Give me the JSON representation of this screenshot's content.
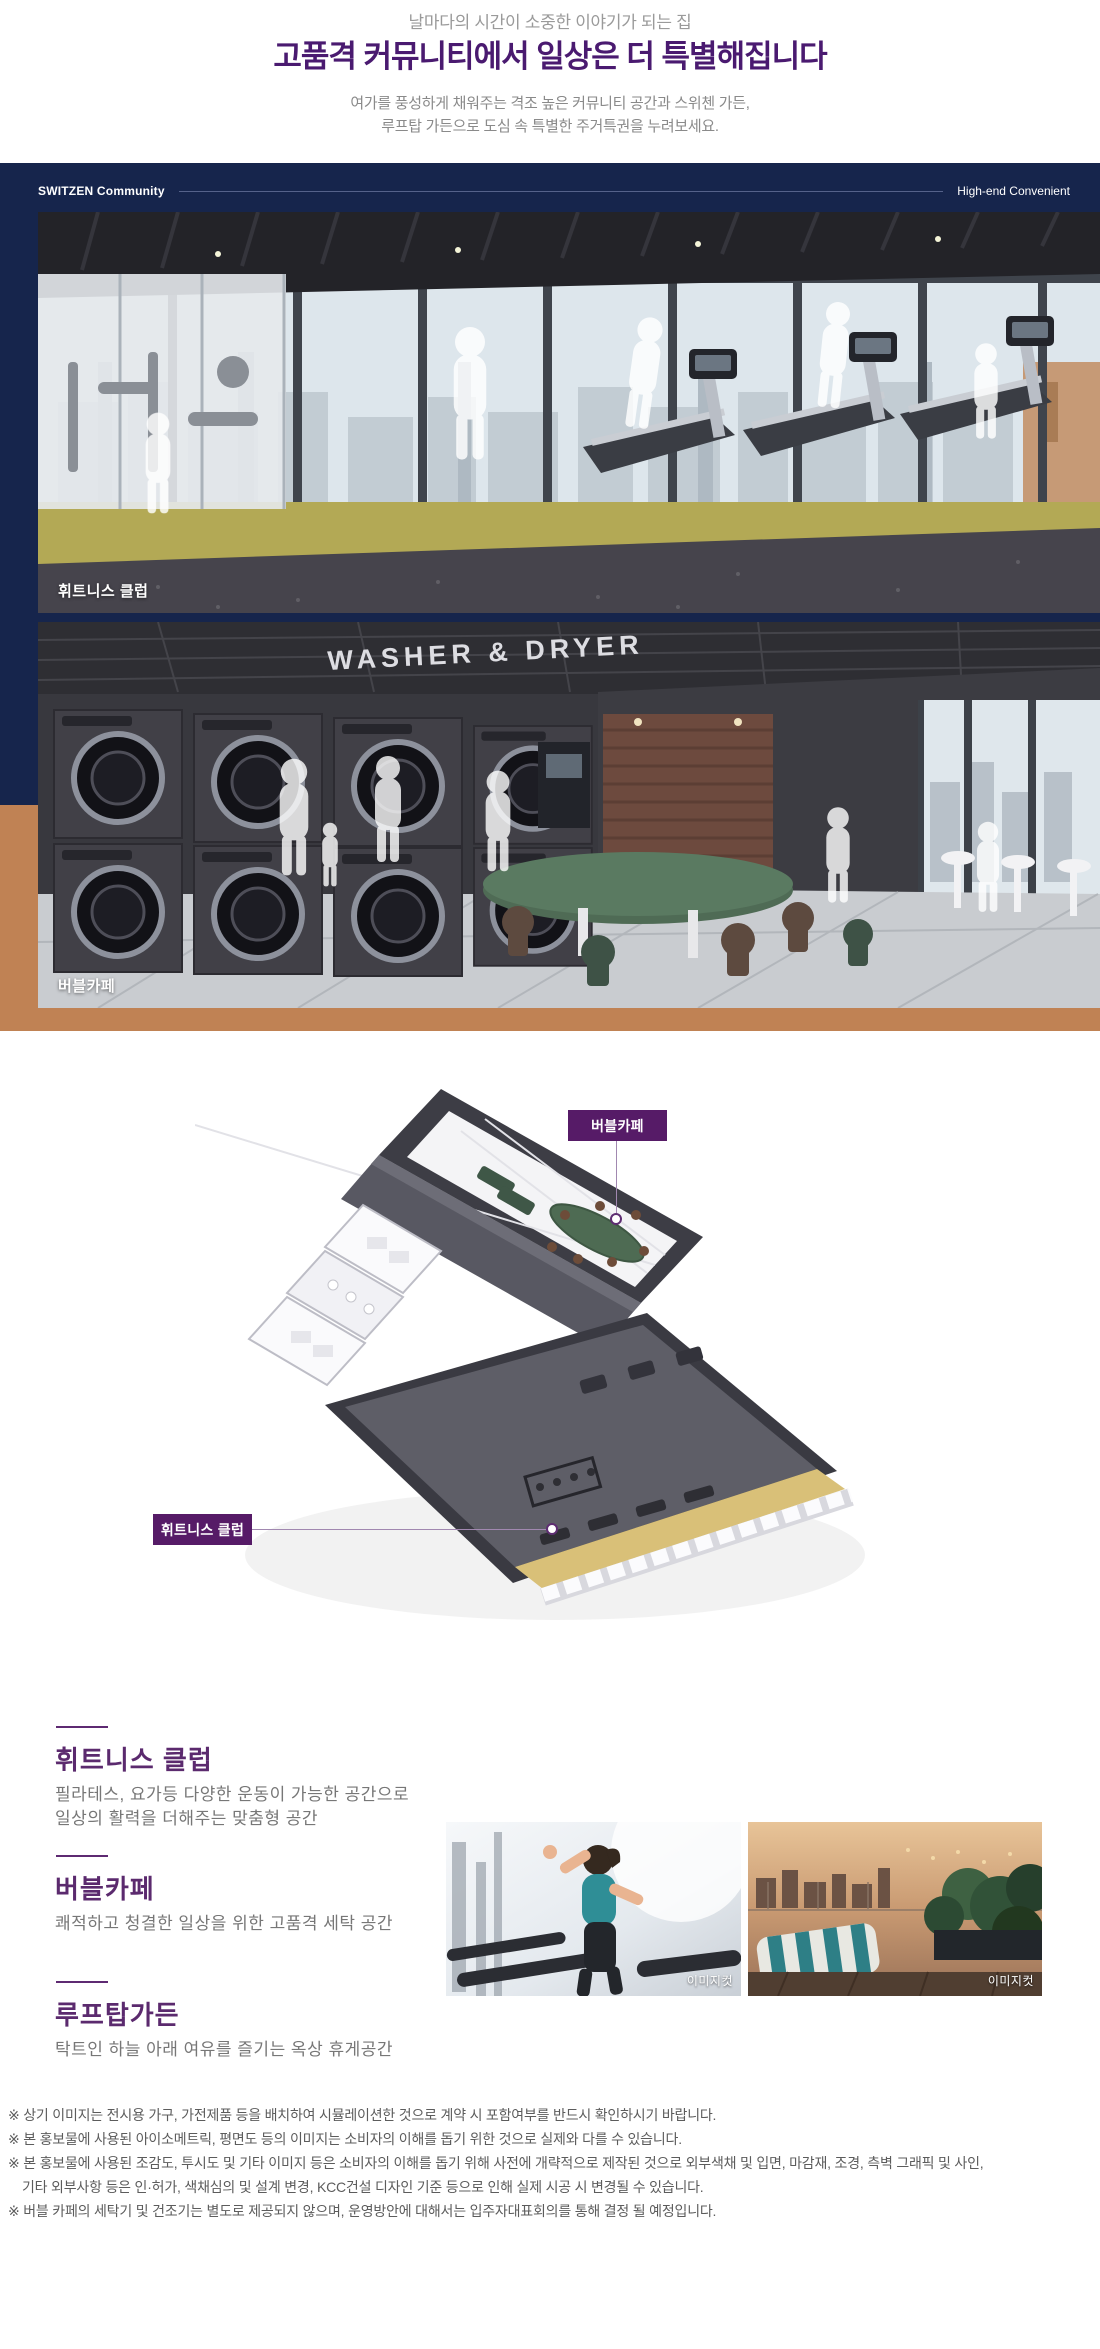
{
  "header": {
    "eyebrow": "날마다의 시간이 소중한 이야기가 되는 집",
    "title": "고품격 커뮤니티에서 일상은 더 특별해집니다",
    "sub1": "여가를 풍성하게 채워주는 격조 높은 커뮤니티 공간과 스위첸 가든,",
    "sub2": "루프탑 가든으로 도심 속 특별한 주거특권을 누려보세요."
  },
  "band": {
    "left_label": "SWITZEN Community",
    "right_label": "High-end Convenient",
    "renders": [
      {
        "caption": "휘트니스 클럽"
      },
      {
        "caption": "버블카페",
        "signage": "WASHER & DRYER"
      }
    ]
  },
  "floorplan": {
    "cafe_label": "버블카페",
    "fitness_label": "휘트니스 클럽"
  },
  "features": [
    {
      "title": "휘트니스 클럽",
      "lines": [
        "필라테스, 요가등 다양한 운동이 가능한 공간으로",
        "일상의 활력을 더해주는 맞춤형 공간"
      ]
    },
    {
      "title": "버블카페",
      "lines": [
        "쾌적하고 청결한 일상을 위한 고품격 세탁 공간"
      ]
    },
    {
      "title": "루프탑가든",
      "lines": [
        "탁트인 하늘 아래 여유를 즐기는 옥상 휴게공간"
      ]
    }
  ],
  "gallery": [
    {
      "tag": "이미지컷"
    },
    {
      "tag": "이미지컷"
    }
  ],
  "footnotes": [
    "※ 상기 이미지는 전시용 가구, 가전제품 등을 배치하여 시뮬레이션한 것으로 계약 시 포함여부를 반드시 확인하시기 바랍니다.",
    "※ 본 홍보물에 사용된 아이소메트릭, 평면도 등의 이미지는 소비자의 이해를 돕기 위한 것으로 실제와 다를 수 있습니다.",
    "※ 본 홍보물에 사용된 조감도, 투시도 및 기타 이미지 등은 소비자의 이해를 돕기 위해 사전에 개략적으로 제작된 것으로 외부색채 및 입면, 마감재, 조경, 측벽 그래픽 및 사인,",
    "기타 외부사항 등은 인·허가, 색채심의 및 설계 변경, KCC건설 디자인 기준 등으로 인해 실제 시공 시 변경될 수 있습니다.",
    "※ 버블 카페의 세탁기 및 건조기는 별도로 제공되지 않으며, 운영방안에 대해서는 입주자대표회의를 통해 결정 될 예정입니다."
  ],
  "colors": {
    "navy": "#16254c",
    "orange": "#c08254",
    "title_purple": "#4a1a70",
    "label_purple": "#561b67"
  }
}
